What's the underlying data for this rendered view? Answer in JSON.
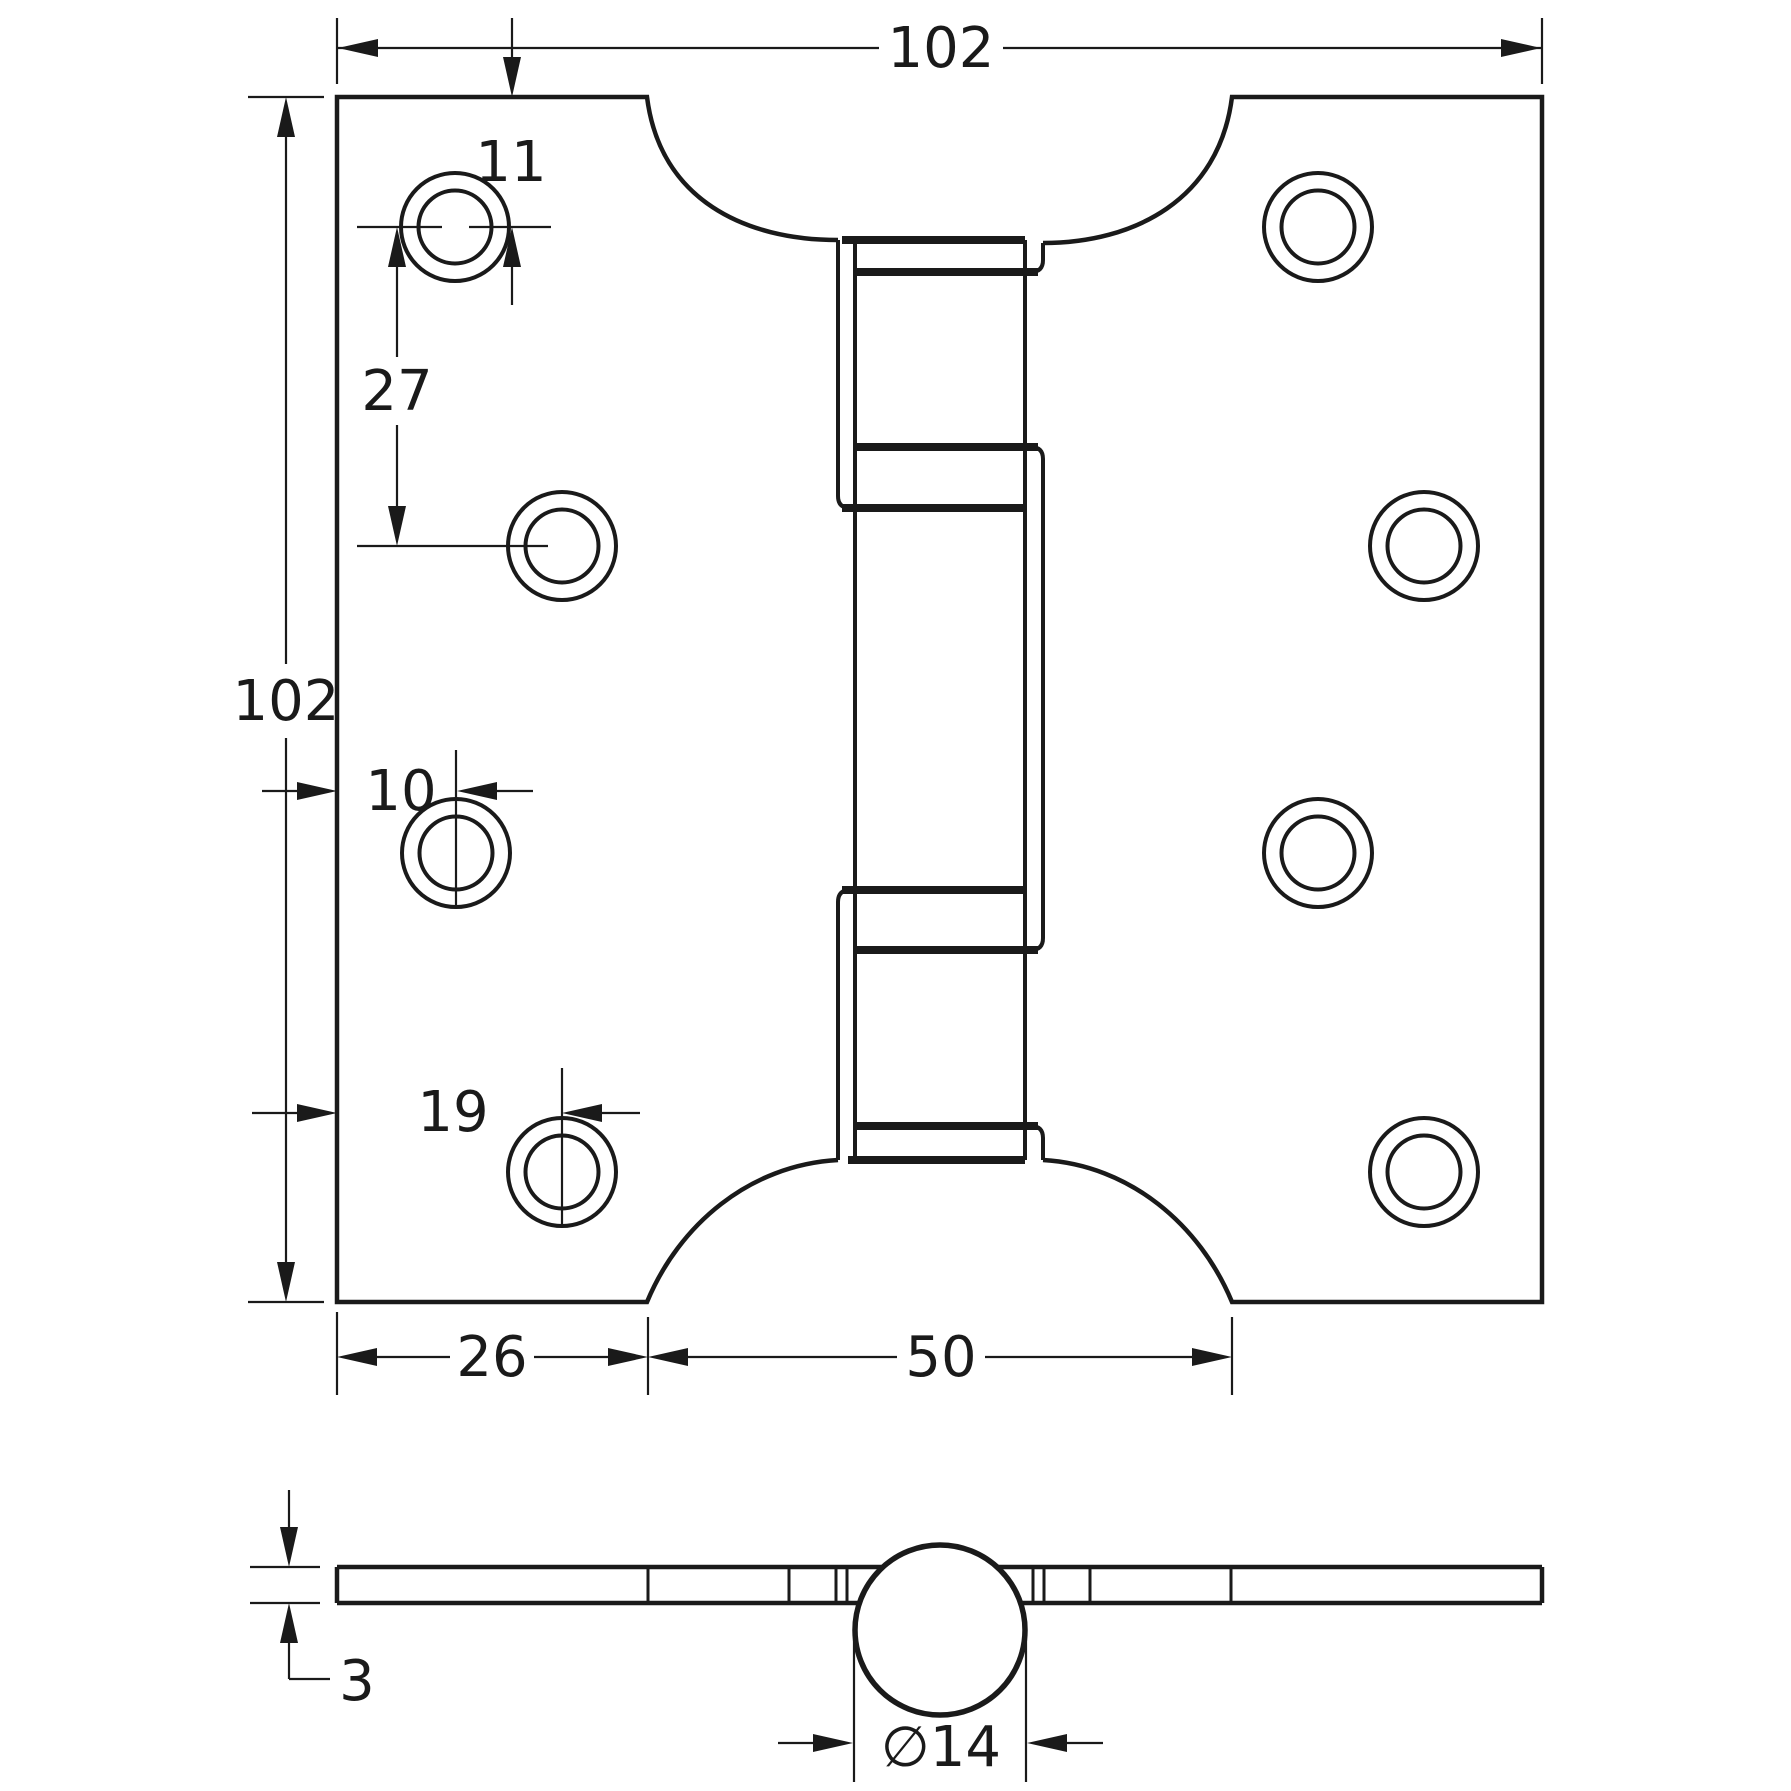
{
  "drawing": {
    "background": "#ffffff",
    "line_color": "#1a1a1a",
    "front_view": {
      "overall_width": "102",
      "overall_height": "102",
      "hole_offset_from_top": "11",
      "hole_vertical_spacing": "27",
      "hole_col_a_offset": "10",
      "hole_col_b_offset": "19",
      "leaf_width": "26",
      "center_cutout_width": "50"
    },
    "section_view": {
      "leaf_thickness": "3",
      "knuckle_diameter": "∅14"
    }
  }
}
